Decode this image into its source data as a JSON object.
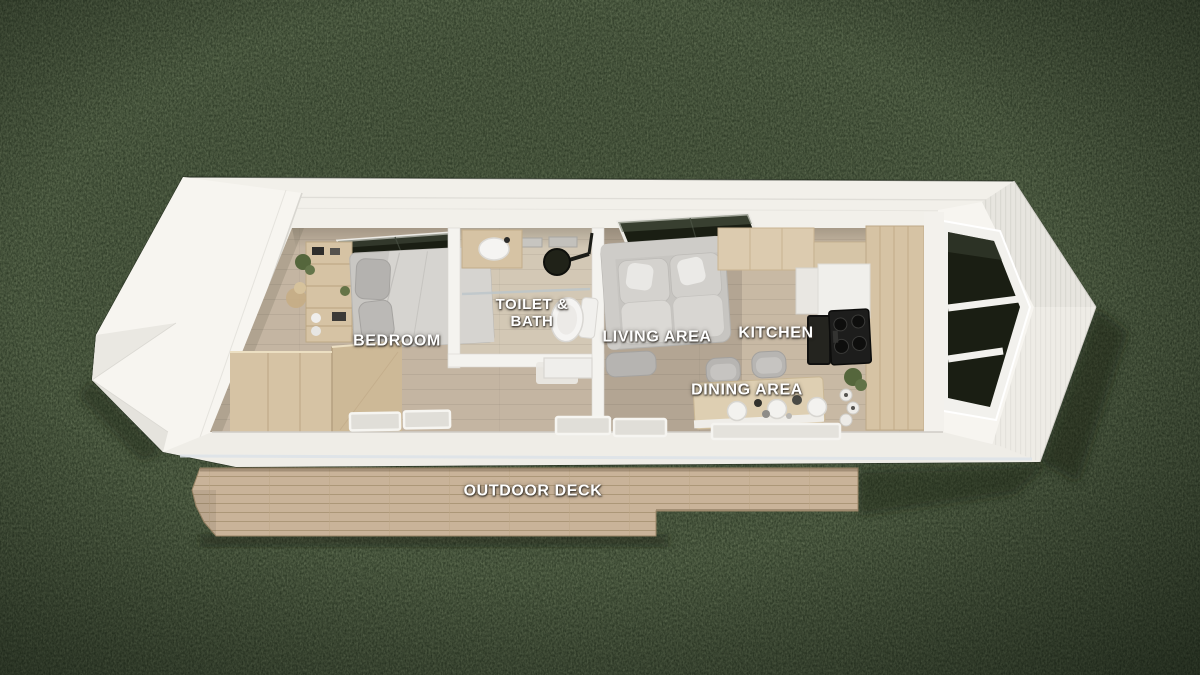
{
  "scene": {
    "description": "Top-down 3D render of a tiny house floor plan on a grass lawn with a wooden outdoor deck"
  },
  "labels": {
    "bedroom": "BEDROOM",
    "toilet_bath_line1": "TOILET &",
    "toilet_bath_line2": "BATH",
    "living": "LIVING AREA",
    "kitchen": "KITCHEN",
    "dining": "DINING AREA",
    "deck": "OUTDOOR DECK"
  },
  "colors": {
    "grass": "#2f3c28",
    "grass_speckle_dark": "#1d2716",
    "grass_speckle_light": "#4d5e39",
    "hull": "#f2f0ea",
    "hull_bright": "#f7f5f0",
    "hull_shade": "#e7e5df",
    "band": "#efede7",
    "sill_highlight": "#dde3e9",
    "floor": "#c4b5a2",
    "floor_living": "#b3a593",
    "floor_kitchen": "#c8b9a4",
    "floor_bath": "#d3c8b5",
    "wood": "#d6c3a4",
    "wood_dark": "#cdb997",
    "deck": "#c9b399",
    "deck_line": "#ac9778",
    "window": "#1a1e13",
    "fabric": "#c7c5c1",
    "fabric_dark": "#b6b4b1",
    "white_fixture": "#f5f4f2",
    "stove": "#1d1d1c",
    "plant": "#55663c",
    "label_text": "#ffffff"
  }
}
